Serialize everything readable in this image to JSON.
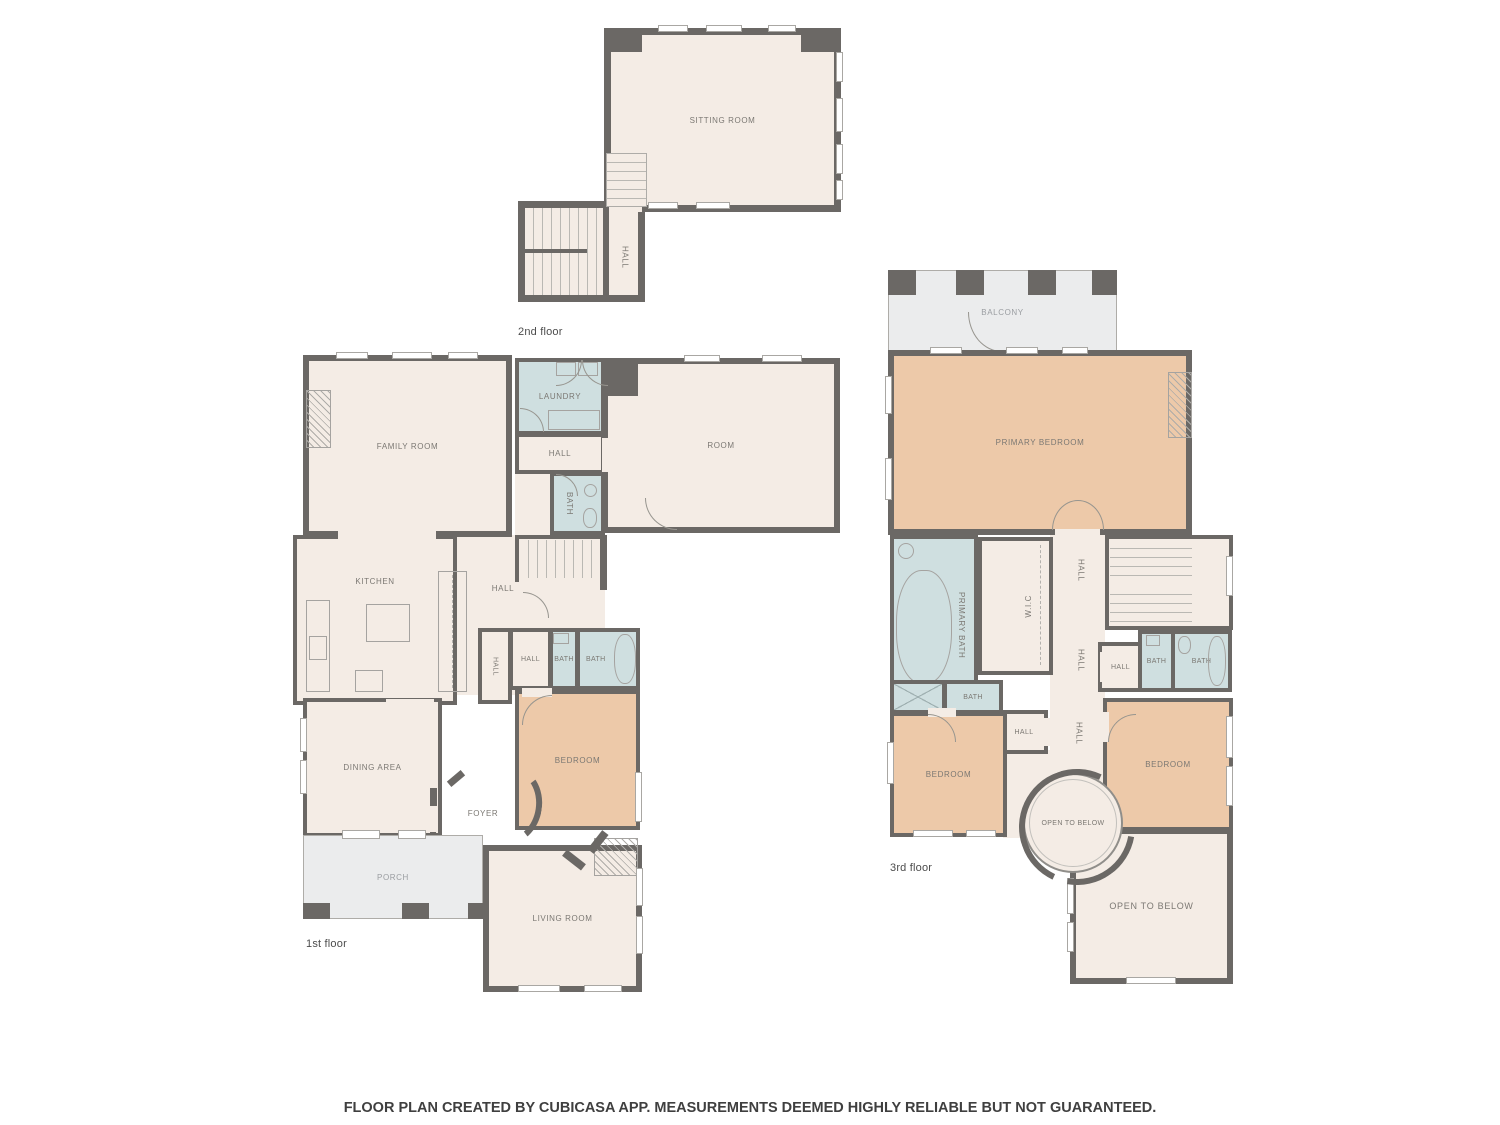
{
  "colors": {
    "wall": "#6b6865",
    "floor": "#f4ece5",
    "bedroom": "#edc9a9",
    "bath": "#cfdfe0",
    "outdoor": "#ebeced",
    "label": "#7b7873"
  },
  "floors": [
    {
      "name": "2nd floor",
      "rooms": [
        {
          "label": "SITTING ROOM"
        },
        {
          "label": "HALL"
        }
      ]
    },
    {
      "name": "1st floor",
      "rooms": [
        {
          "label": "FAMILY ROOM"
        },
        {
          "label": "LAUNDRY"
        },
        {
          "label": "HALL"
        },
        {
          "label": "BATH"
        },
        {
          "label": "ROOM"
        },
        {
          "label": "KITCHEN"
        },
        {
          "label": "HALL"
        },
        {
          "label": "HALL"
        },
        {
          "label": "HALL"
        },
        {
          "label": "BATH"
        },
        {
          "label": "BATH"
        },
        {
          "label": "DINING AREA"
        },
        {
          "label": "BEDROOM"
        },
        {
          "label": "FOYER"
        },
        {
          "label": "PORCH"
        },
        {
          "label": "LIVING ROOM"
        }
      ]
    },
    {
      "name": "3rd floor",
      "rooms": [
        {
          "label": "BALCONY"
        },
        {
          "label": "PRIMARY BEDROOM"
        },
        {
          "label": "PRIMARY BATH"
        },
        {
          "label": "W.I.C"
        },
        {
          "label": "HALL"
        },
        {
          "label": "HALL"
        },
        {
          "label": "HALL"
        },
        {
          "label": "HALL"
        },
        {
          "label": "BATH"
        },
        {
          "label": "BATH"
        },
        {
          "label": "BATH"
        },
        {
          "label": "HALL"
        },
        {
          "label": "BEDROOM"
        },
        {
          "label": "BEDROOM"
        },
        {
          "label": "OPEN TO BELOW"
        },
        {
          "label": "OPEN TO BELOW"
        }
      ]
    }
  ],
  "footer": {
    "text": "FLOOR PLAN CREATED BY CUBICASA APP. MEASUREMENTS DEEMED HIGHLY RELIABLE BUT NOT GUARANTEED."
  }
}
